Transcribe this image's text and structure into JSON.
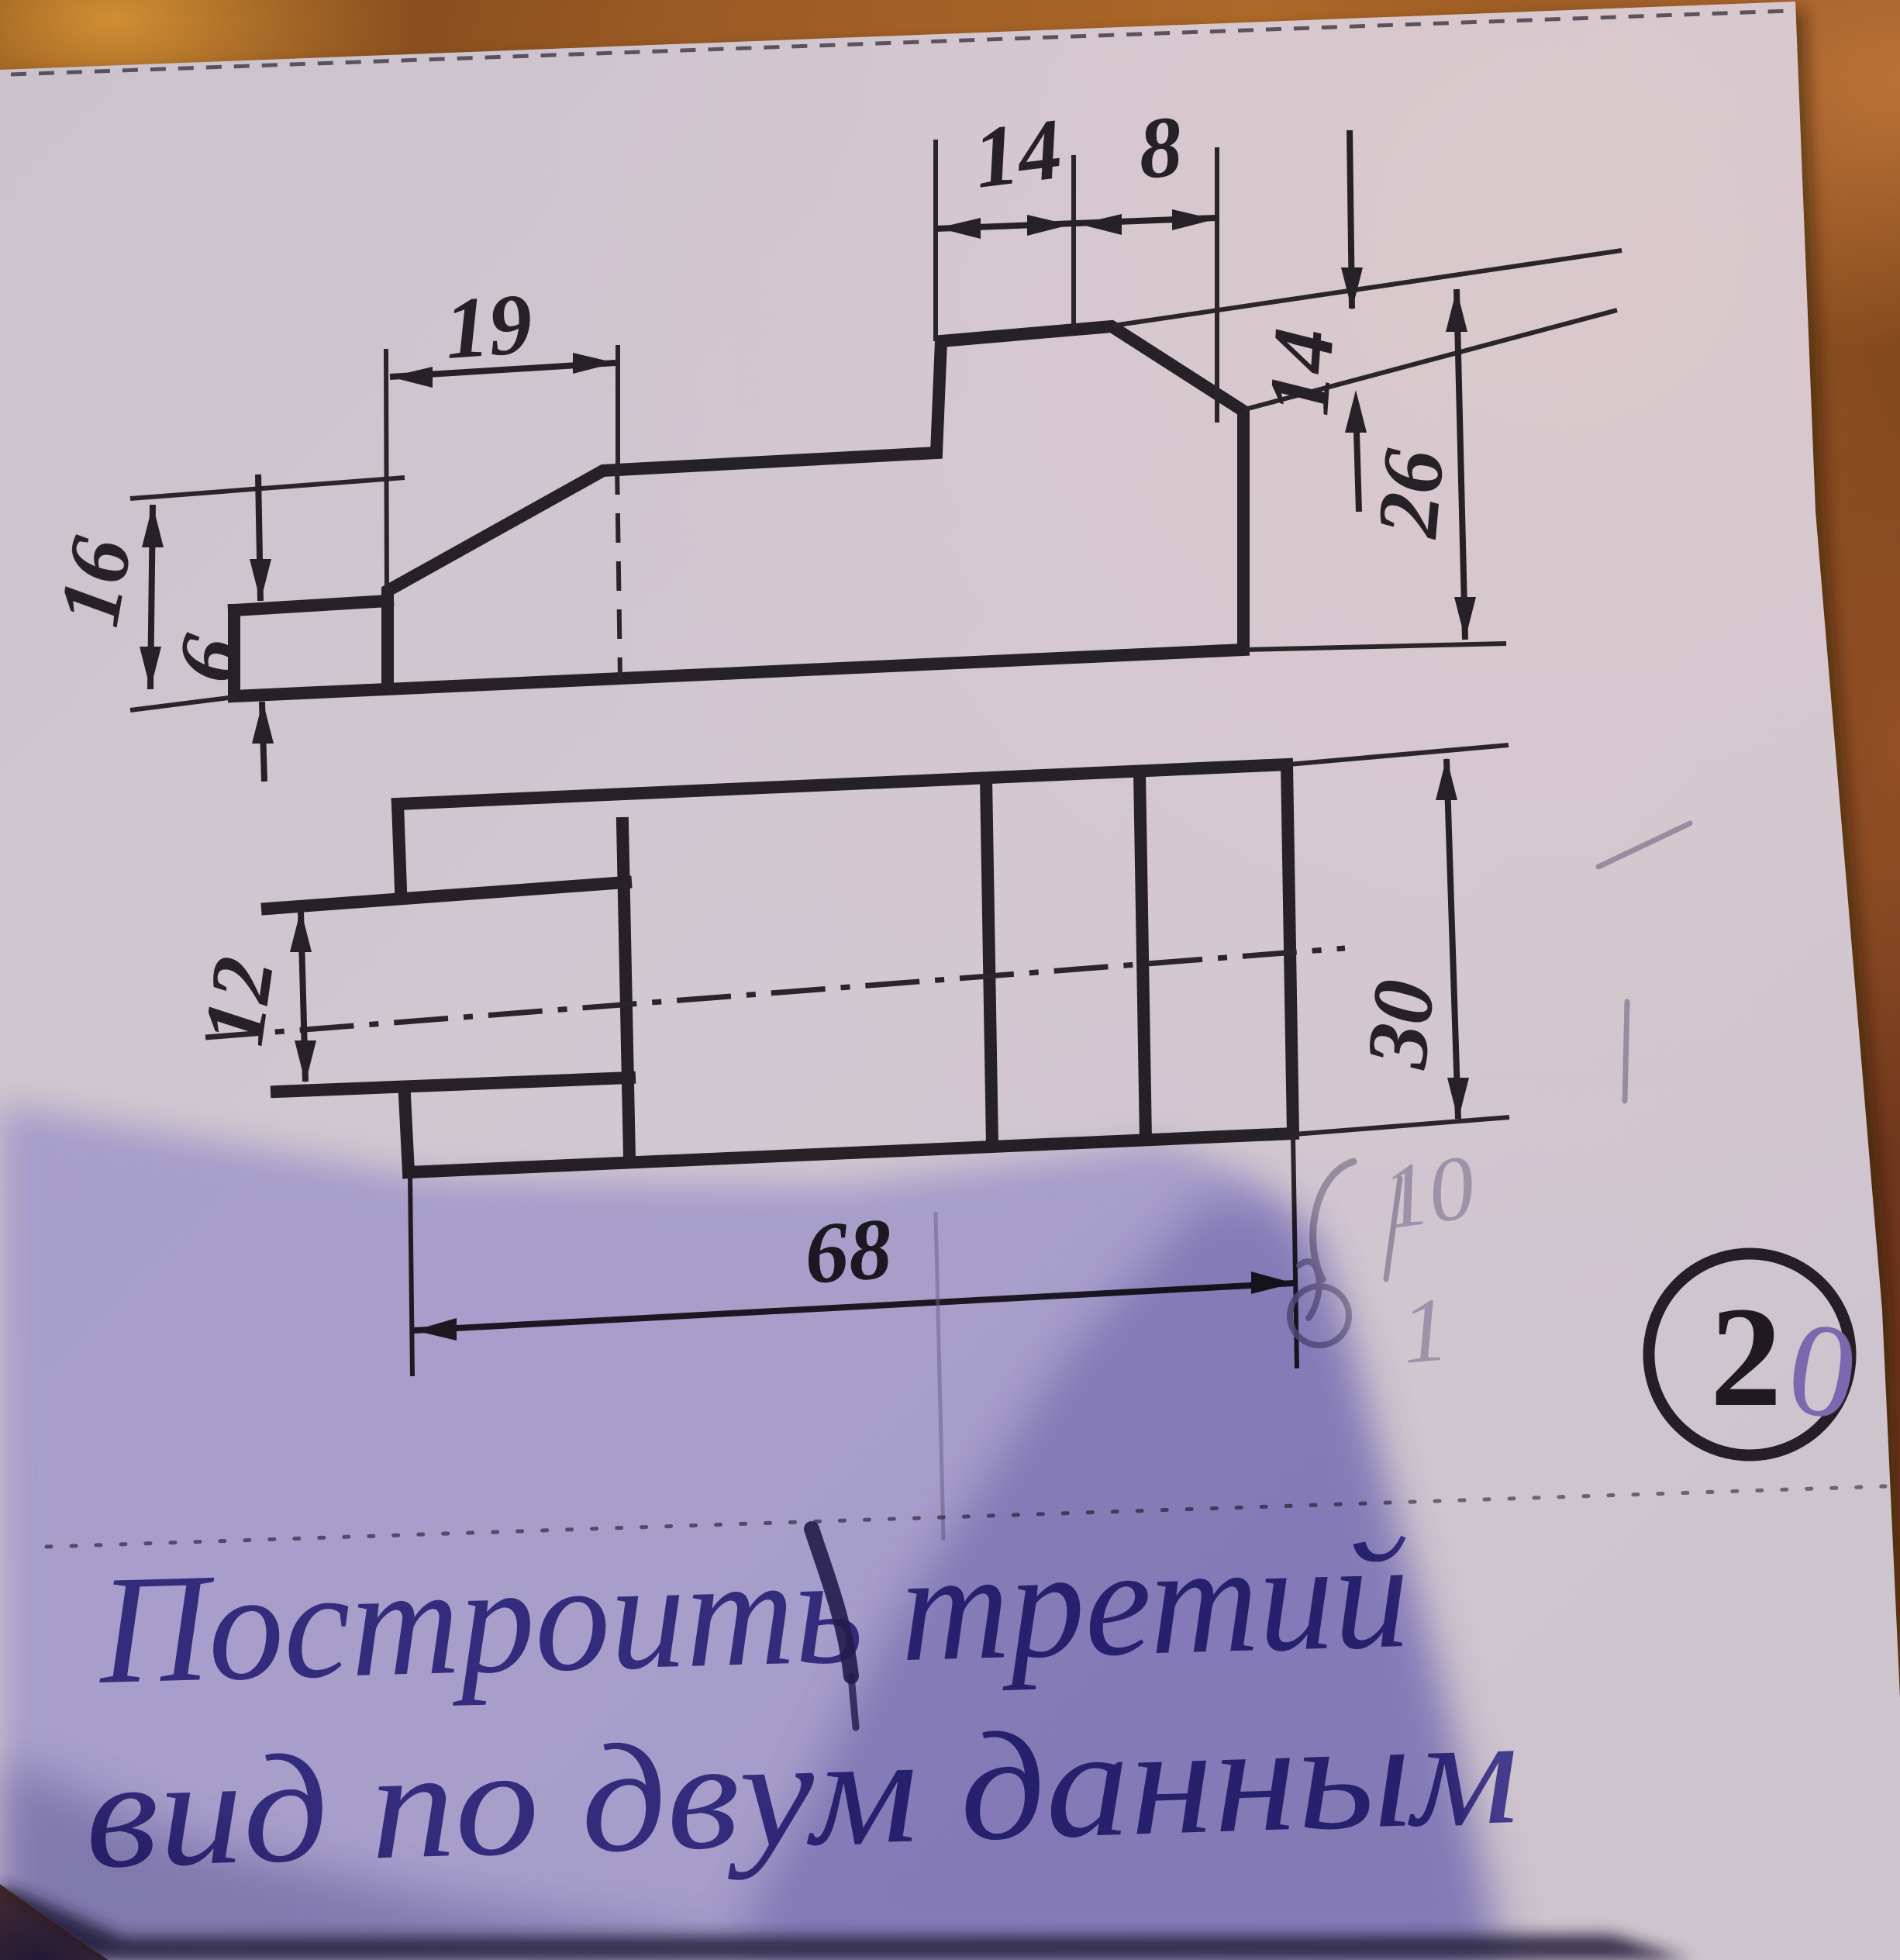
{
  "photo": {
    "paper_color": "#cfc6cf",
    "wood_color": "#9a5a24",
    "shadow_color": "#7d74bd",
    "line_color": "#262126",
    "ink_color": "#463c8e",
    "pencil_color": "#8b8298"
  },
  "front_view": {
    "dim_width_chamfer": "19",
    "dim_top_left": "14",
    "dim_top_right": "8",
    "dim_height_left_total": "16",
    "dim_height_step": "6",
    "dim_height_chamfer_right": "14",
    "dim_height_right_total": "26"
  },
  "plan_view": {
    "dim_slot_width": "12",
    "dim_depth": "30",
    "dim_length": "68"
  },
  "badge": {
    "digit_black": "2",
    "digit_purple": "0"
  },
  "caption": {
    "line1": "Построить третий",
    "line2": "вид по двум данным"
  },
  "pencil_marks": {
    "mark_ten": "10",
    "mark_one": "1"
  }
}
